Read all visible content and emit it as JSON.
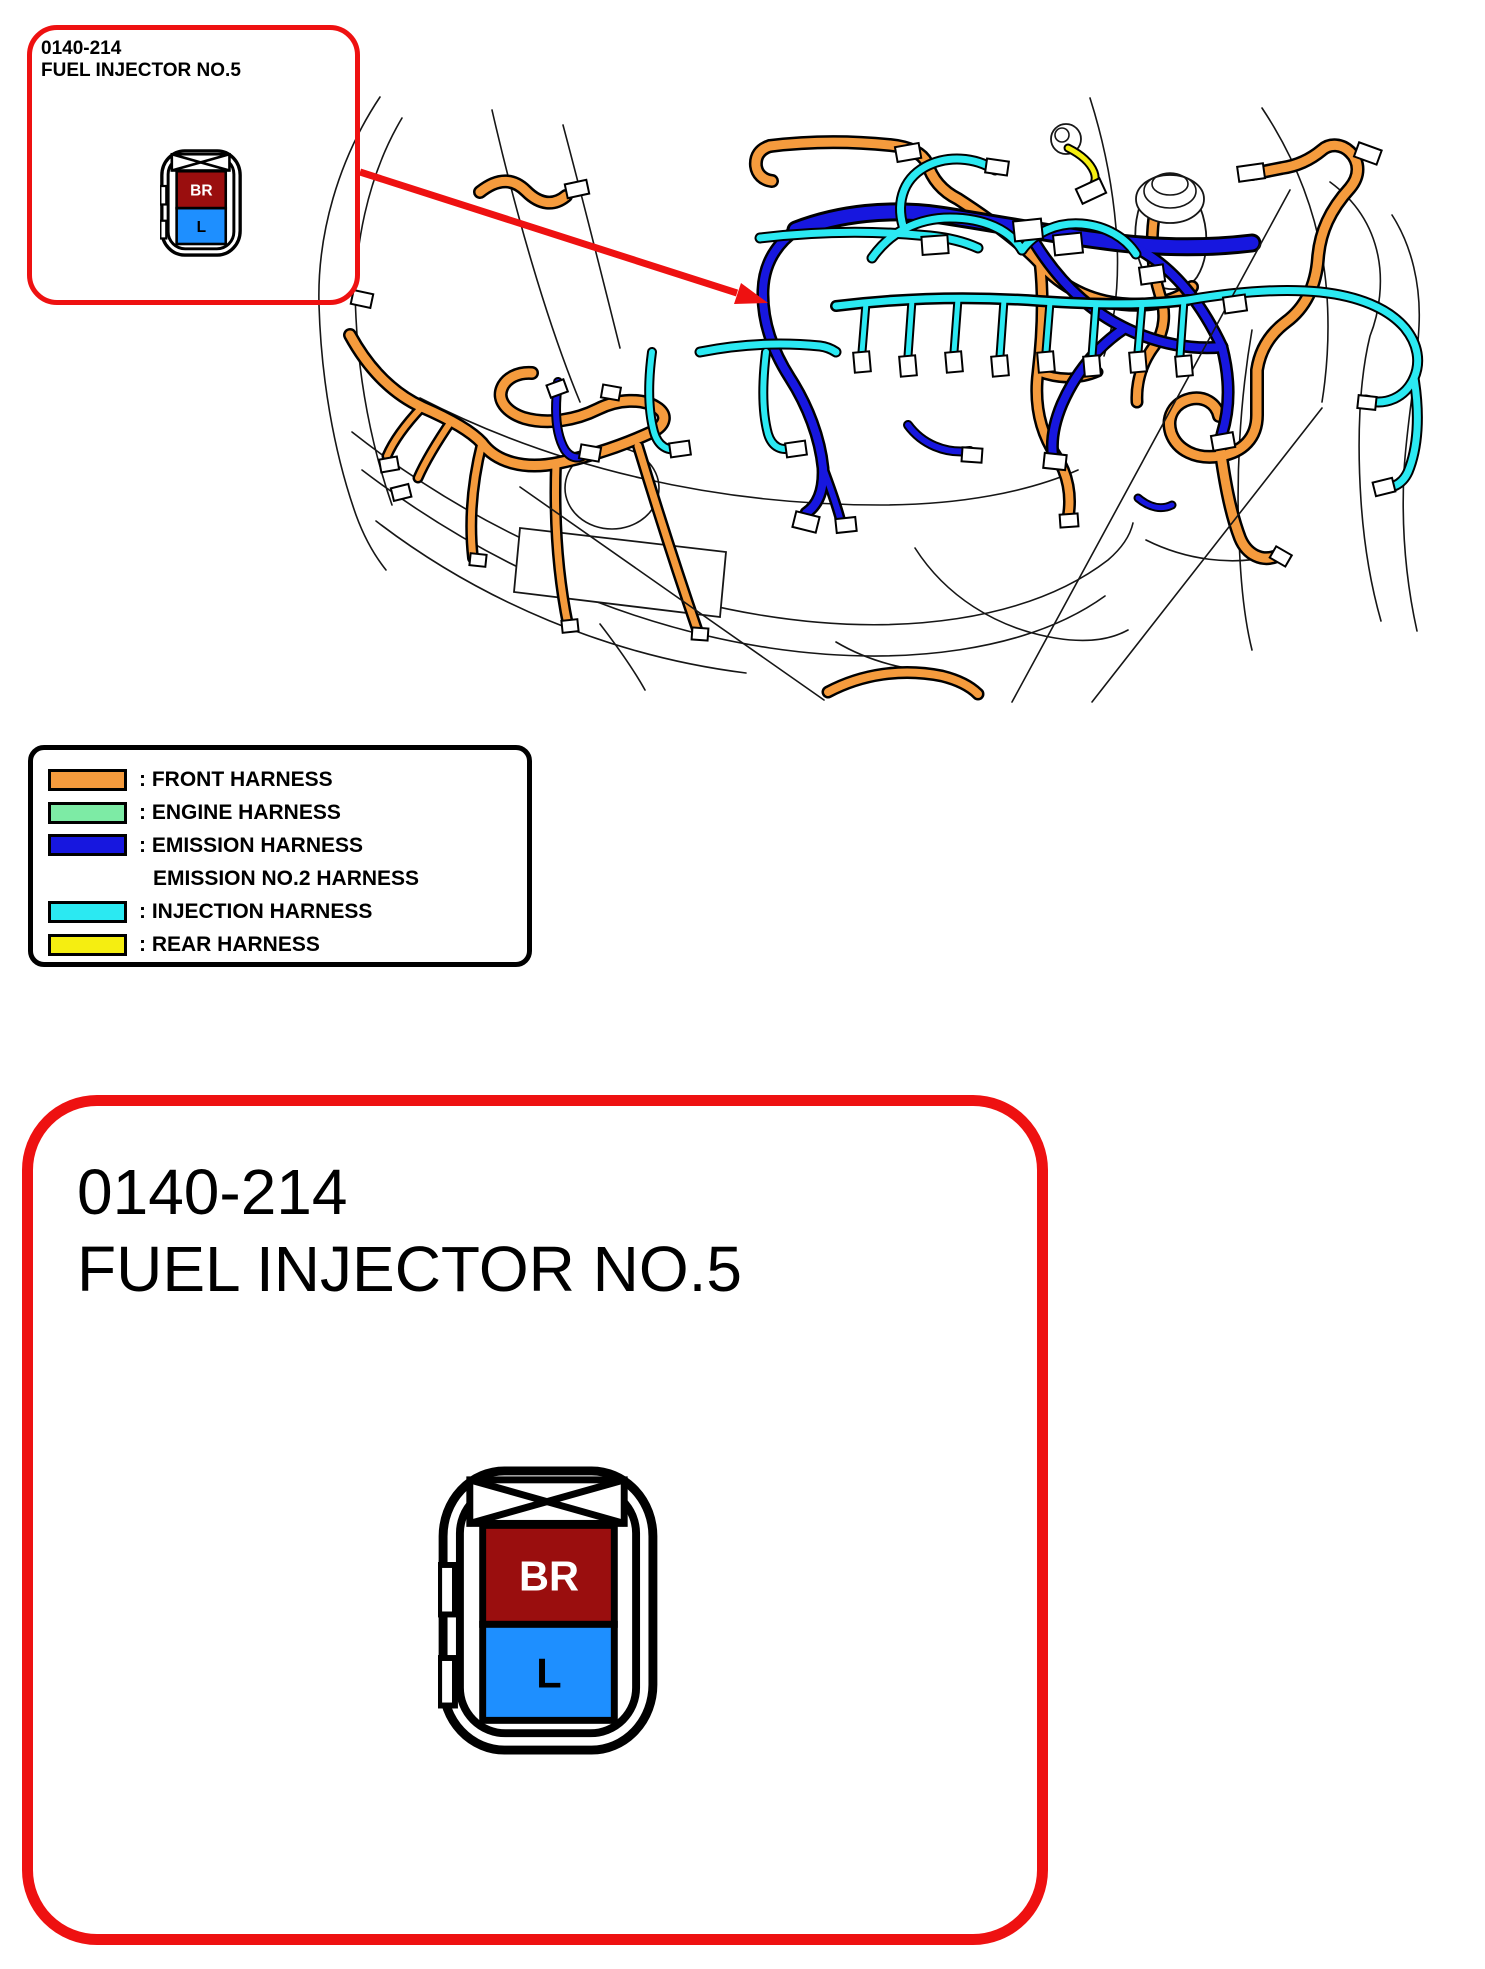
{
  "callout": {
    "code": "0140-214",
    "name": "FUEL INJECTOR NO.5"
  },
  "detail_panel": {
    "code": "0140-214",
    "name": "FUEL INJECTOR NO.5"
  },
  "connector": {
    "pin_top": "BR",
    "pin_bottom": "L"
  },
  "legend": {
    "items": [
      {
        "key": "front_harness",
        "label": ": FRONT HARNESS"
      },
      {
        "key": "engine_harness",
        "label": ": ENGINE HARNESS"
      },
      {
        "key": "emission_harness",
        "label": ": EMISSION HARNESS",
        "label2": "EMISSION NO.2 HARNESS"
      },
      {
        "key": "injection_harness",
        "label": ": INJECTION HARNESS"
      },
      {
        "key": "rear_harness",
        "label": ": REAR HARNESS"
      }
    ]
  },
  "colors": {
    "front_harness": "#F59B3D",
    "engine_harness": "#7DEBA5",
    "emission_harness": "#1717DF",
    "injection_harness": "#2BE9F2",
    "rear_harness": "#F5EE11",
    "callout_border": "#EE1111",
    "pin_br": "#9A0E0E",
    "pin_l": "#1E8FFF"
  }
}
